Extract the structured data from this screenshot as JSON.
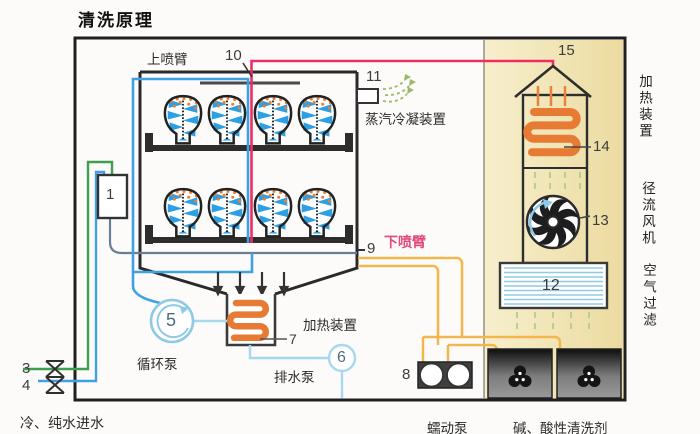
{
  "title": "清洗原理",
  "chamber": {
    "upper_spray_arm": "上喷臂",
    "lower_spray_arm": "下喷臂",
    "steam_condenser": "蒸汽冷凝装置"
  },
  "components": {
    "circulation_pump": "循环泵",
    "drain_pump": "排水泵",
    "sump_heater": "加热装置",
    "peristaltic_pump": "蠕动泵",
    "detergents": "碱、酸性清洗剂",
    "water_inlet": "冷、纯水进水"
  },
  "side_panel": {
    "heater": "加热装置",
    "radial_fan": "径流风机",
    "air_filter": "空气过滤"
  },
  "callouts": {
    "c1": "1",
    "c3": "3",
    "c4": "4",
    "c5": "5",
    "c6": "6",
    "c7": "7",
    "c8": "8",
    "c9": "9",
    "c10": "10",
    "c11": "11",
    "c12": "12",
    "c13": "13",
    "c14": "14",
    "c15": "15"
  },
  "colors": {
    "steam_line_pink": "#ed2f66",
    "pipe_blue": "#3ea2e2",
    "pipe_light_blue": "#a6d8ee",
    "pipe_green": "#3f9e4f",
    "dosing_orange": "#f3b64c",
    "coil_orange": "#e87b33",
    "panel_beige": "#f0e2ae",
    "spray_blue": "#2da0e4",
    "droplet_orange": "#ef7d2e",
    "steam_green": "#9db96a",
    "lower_arm_label_red": "#e34a7a"
  }
}
